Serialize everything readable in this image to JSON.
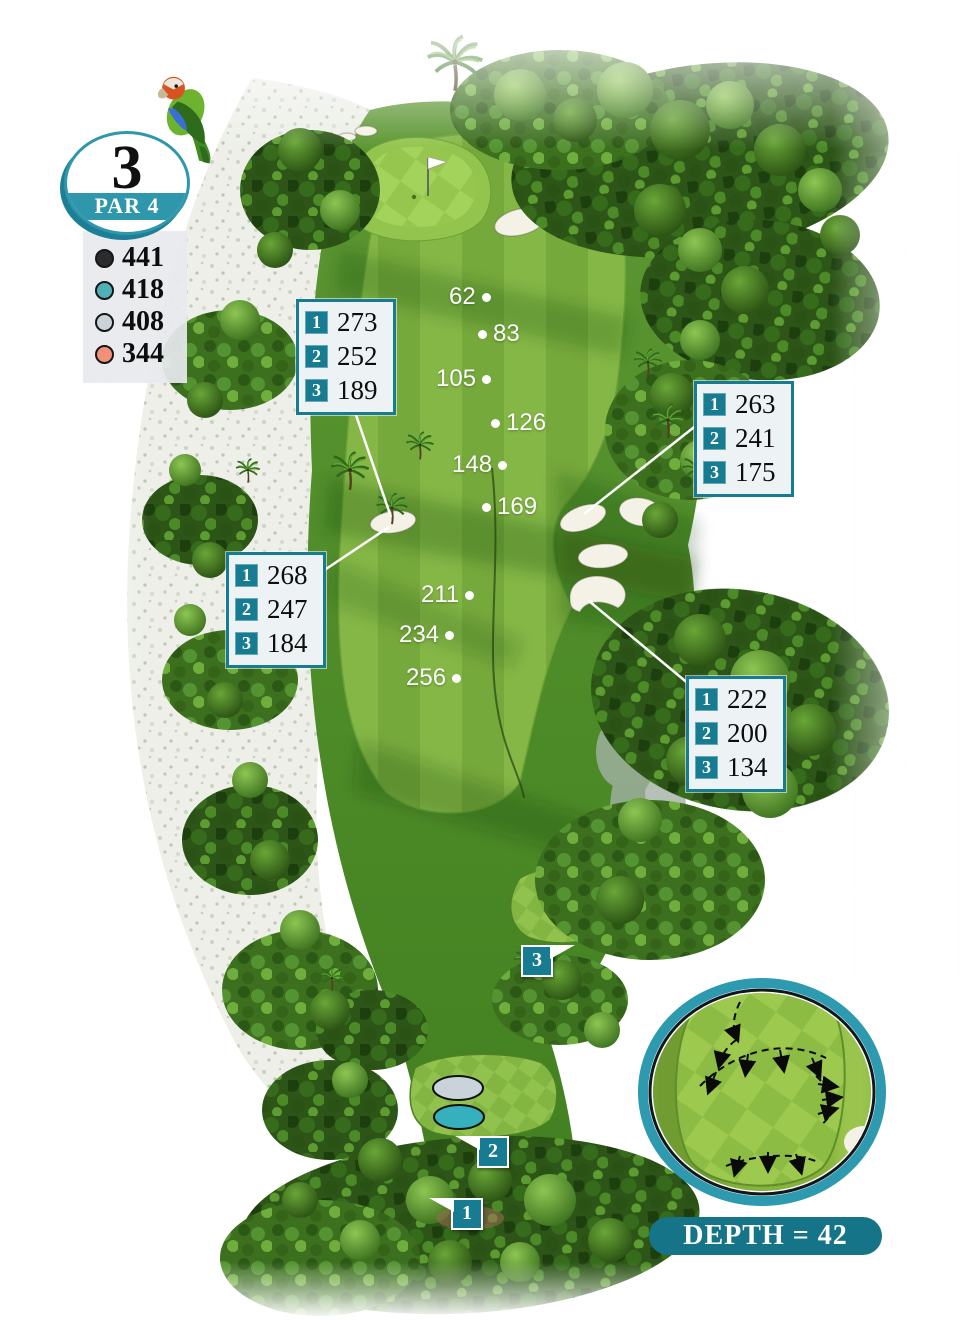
{
  "hole": {
    "number": "3",
    "par_label": "PAR 4"
  },
  "legend": {
    "tees": [
      {
        "name": "black",
        "color": "#2b2b2e",
        "yardage": "441"
      },
      {
        "name": "teal",
        "color": "#35b0bc",
        "yardage": "418"
      },
      {
        "name": "silver",
        "color": "#c9d3d9",
        "yardage": "408"
      },
      {
        "name": "orange",
        "color": "#f2907a",
        "yardage": "344"
      }
    ]
  },
  "callouts": [
    {
      "position": "upper-left",
      "rows": [
        {
          "tee": "1",
          "yards": "273"
        },
        {
          "tee": "2",
          "yards": "252"
        },
        {
          "tee": "3",
          "yards": "189"
        }
      ]
    },
    {
      "position": "upper-right",
      "rows": [
        {
          "tee": "1",
          "yards": "263"
        },
        {
          "tee": "2",
          "yards": "241"
        },
        {
          "tee": "3",
          "yards": "175"
        }
      ]
    },
    {
      "position": "mid-left",
      "rows": [
        {
          "tee": "1",
          "yards": "268"
        },
        {
          "tee": "2",
          "yards": "247"
        },
        {
          "tee": "3",
          "yards": "184"
        }
      ]
    },
    {
      "position": "mid-right",
      "rows": [
        {
          "tee": "1",
          "yards": "222"
        },
        {
          "tee": "2",
          "yards": "200"
        },
        {
          "tee": "3",
          "yards": "134"
        }
      ]
    }
  ],
  "distance_markers": [
    {
      "value": "62",
      "dot_side": "right"
    },
    {
      "value": "83",
      "dot_side": "left"
    },
    {
      "value": "105",
      "dot_side": "right"
    },
    {
      "value": "126",
      "dot_side": "left"
    },
    {
      "value": "148",
      "dot_side": "right"
    },
    {
      "value": "169",
      "dot_side": "left"
    },
    {
      "value": "211",
      "dot_side": "right"
    },
    {
      "value": "234",
      "dot_side": "right"
    },
    {
      "value": "256",
      "dot_side": "right"
    }
  ],
  "tee_boxes": [
    {
      "label": "1"
    },
    {
      "label": "2"
    },
    {
      "label": "3"
    }
  ],
  "green_inset": {
    "depth_label": "DEPTH = 42"
  },
  "icons": {
    "mascot": "parrot-icon",
    "flag": "pin-flag-icon"
  },
  "colors": {
    "teal_primary": "#177b91",
    "teal_badge": "#2f97ac",
    "banner_teal": "#157487",
    "sand": "#edefe8",
    "fairway_light": "#84b746",
    "fairway_dark": "#76a93c",
    "green_checker_light": "#a4d35b",
    "green_checker_dark": "#97c64f",
    "white": "#ffffff"
  }
}
